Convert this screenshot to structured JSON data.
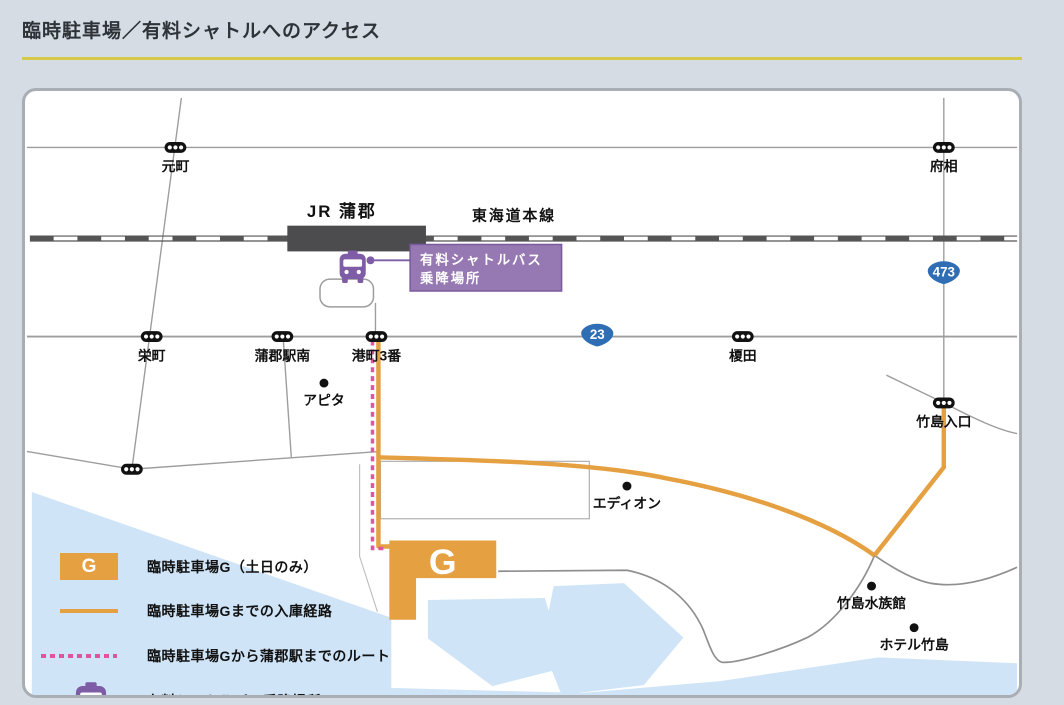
{
  "title": "臨時駐車場／有料シャトルへのアクセス",
  "station": {
    "name": "JR 蒲郡",
    "line": "東海道本線"
  },
  "route_badges": [
    {
      "number": "23"
    },
    {
      "number": "473"
    }
  ],
  "signals": [
    {
      "name": "元町"
    },
    {
      "name": "府相"
    },
    {
      "name": "栄町"
    },
    {
      "name": "蒲郡駅南"
    },
    {
      "name": "港町3番"
    },
    {
      "name": "榎田"
    },
    {
      "name": "竹島入口"
    }
  ],
  "landmarks": [
    {
      "name": "アピタ"
    },
    {
      "name": "エディオン"
    },
    {
      "name": "竹島水族館"
    },
    {
      "name": "ホテル竹島"
    }
  ],
  "shuttle_stop_label": {
    "line1": "有料シャトルバス",
    "line2": "乗降場所"
  },
  "parking_lot": {
    "label": "G"
  },
  "legend": {
    "items": [
      {
        "swatch": "parking-box",
        "swatch_label": "G",
        "label": "臨時駐車場G（土日のみ）"
      },
      {
        "swatch": "orange-line",
        "label": "臨時駐車場Gまでの入庫経路"
      },
      {
        "swatch": "pink-dashed-line",
        "label": "臨時駐車場Gから蒲郡駅までのルート"
      },
      {
        "swatch": "bus-icon",
        "label": "有料シャトルバス乗降場所"
      }
    ]
  },
  "colors": {
    "accent_orange": "#e5a042",
    "route_pink": "#e0559e",
    "shuttle_purple": "#7e5da6",
    "badge_blue": "#2f6db5",
    "water": "#cfe4f7",
    "title_underline": "#d6c94a",
    "station_gray": "#4c4c4e"
  }
}
